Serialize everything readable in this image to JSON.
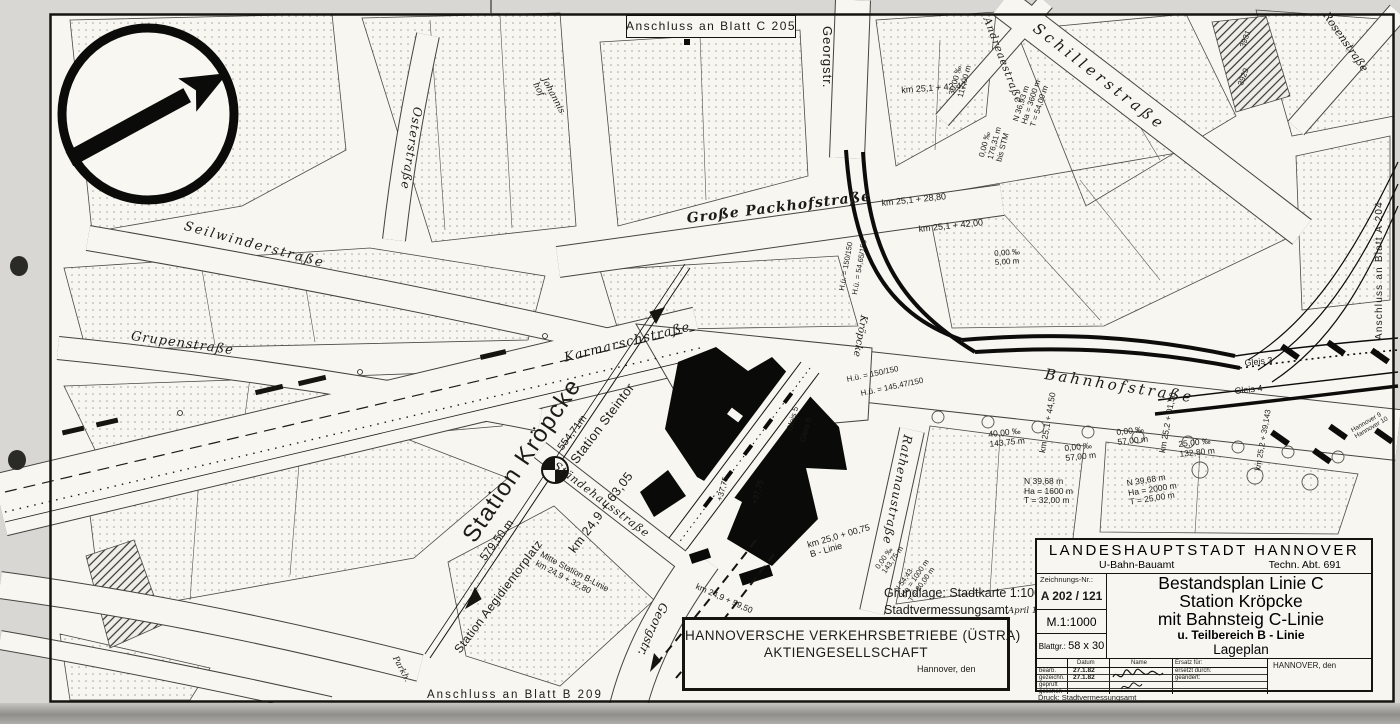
{
  "connections": {
    "top": "Anschluss an Blatt C 205",
    "right": "Anschluss an Blatt A 204",
    "bottom": "Anschluss an Blatt B 209"
  },
  "streets": {
    "georgstr_top": "Georgstr.",
    "georgstr_bottom": "Georgstr.",
    "schillerstrasse": "Schillerstraße",
    "andreaestrasse": "Andreaestraße",
    "rosenstrasse": "Rosenstraße",
    "osterstrasse": "Osterstraße",
    "johannishof_1": "Johannis",
    "johannishof_2": "hof",
    "seilwinderstrasse": "Seilwinderstraße",
    "grupenstrasse": "Grupenstraße",
    "grosse_packhofstrasse": "Große Packhofstraße",
    "karmarschstrasse": "Karmarschstraße",
    "bahnhofstrasse": "Bahnhofstraße",
    "rathenaustrasse": "Rathenaustraße",
    "staendehausstrasse": "Ständehausstraße",
    "kroepcke_platz": "Kröpcke",
    "parkhaus": "Parkh."
  },
  "stations": {
    "kroepcke": "Station Kröpcke",
    "steintor": "Station Steintor",
    "aegidientorplatz": "Station Aegidientorplatz",
    "mitte_b_1": "Mitte Station B-Linie",
    "mitte_b_2": "km 24,9 + 32,80"
  },
  "axis": {
    "length_ne": "554,71m",
    "km_center": "km 24,9 + 63,05",
    "length_sw": "579,50 m"
  },
  "km_marks": {
    "k2542_42": "km 25,1 + 42,42",
    "k2528_80": "km 25,1 + 28,80",
    "k2542_00": "km 25,1 + 42,00",
    "k2544_50": "km 25,1 + 44,50",
    "k2501_50": "km 25,2 + 01,50",
    "k2539_143": "km 25,2 + 39,143",
    "k2500_75": "km 25,0 + 00,75",
    "b_linie": "B - Linie",
    "k2459_50": "km 24,9 + 59,50"
  },
  "gradients": {
    "g1_1": "30,00 ‰",
    "g1_2": "117,00 m",
    "g2_1": "0,00 ‰",
    "g2_2": "176,31 m",
    "g2_3": "bis STM",
    "g3_1": "0,00 ‰",
    "g3_2": "57,00 m",
    "g4_1": "40,00 ‰",
    "g4_2": "143,75 m",
    "g5_1": "0,00 ‰",
    "g5_2": "143,75 m",
    "g6_1": "25,00 ‰",
    "g6_2": "132,80 m",
    "g7_1": "0,00 ‰",
    "g7_2": "5,00 m"
  },
  "curves": {
    "c1_1": "N 36,93 m",
    "c1_2": "Ha = 3600 m",
    "c1_3": "T = 54,00 m",
    "c2_1": "N 39,68 m",
    "c2_2": "Ha = 1600 m",
    "c2_3": "T = 32,00 m",
    "c3_1": "N 39,68 m",
    "c3_2": "Ha = 2000 m",
    "c3_3": "T = 25,00 m",
    "c4_1": "N 54,43",
    "c4_2": "Ha = 1000 m",
    "c4_3": "T = 20,00 m"
  },
  "heights": {
    "h1": "H.ü. = 150/150",
    "h2": "H.ü. = 54,65/150",
    "h3": "H.ü. = 150/150",
    "h4": "H.ü. = 145,47/150"
  },
  "tracks": {
    "gleis3": "Gleis 3",
    "gleis4": "Gleis 4",
    "gleis5": "Gleis 5",
    "gleis6": "Gleis 6",
    "hannover9": "Hannover 9",
    "hannover10": "Hannover 10",
    "plus37": "+37,75"
  },
  "parcels": {
    "p3931": "3931",
    "p3929": "3929"
  },
  "source_note": {
    "line1": "Grundlage: Stadtkarte 1:1000",
    "line2": "Stadtvermessungsamt",
    "line3": "April 1977"
  },
  "company_box": {
    "line1": "HANNOVERSCHE VERKEHRSBETRIEBE (ÜSTRA)",
    "line2": "AKTIENGESELLSCHAFT",
    "date_line": "Hannover, den"
  },
  "title_block": {
    "authority": "LANDESHAUPTSTADT HANNOVER",
    "office": "U-Bahn-Bauamt",
    "department": "Techn. Abt. 691",
    "drawing_no_label": "Zeichnungs-Nr.:",
    "drawing_no": "A 202 / 121",
    "scale": "M.1:1000",
    "sheet_size_label": "Blattgr.:",
    "sheet_size": "58 x 30",
    "title_line1": "Bestandsplan Linie C",
    "title_line2": "Station Kröpcke",
    "title_line3": "mit Bahnsteig C-Linie",
    "title_line4": "u. Teilbereich B - Linie",
    "title_line5": "Lageplan",
    "col_datum": "Datum",
    "col_name": "Name",
    "col_ersatz": "Ersatz für:",
    "row1_label": "bearb.",
    "row1_date": "27.1.82",
    "row2_label": "gezeichn.",
    "row2_date": "27.1.82",
    "row3_label": "geprüft",
    "row4_label": "gesehen",
    "ersetzt_durch": "ersetzt durch:",
    "geaendert": "geändert:",
    "city": "HANNOVER, den",
    "print_note": "Druck: Stadtvermessungsamt"
  },
  "colors": {
    "paper": "#f7f6f1",
    "ink": "#15140f",
    "scan_background": "#d8d7d3"
  }
}
